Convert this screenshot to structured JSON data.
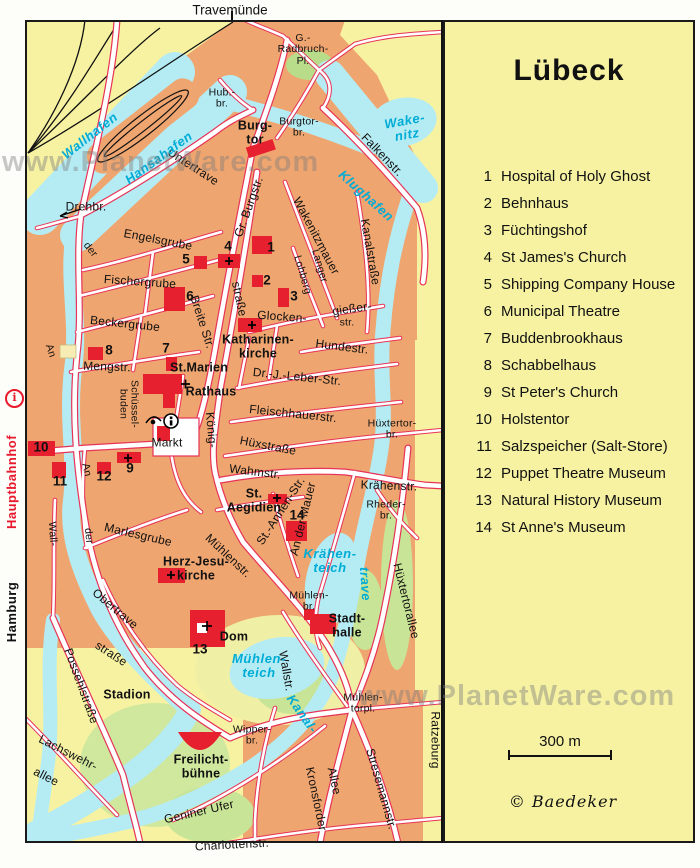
{
  "watermark": "www.PlanetWare.com",
  "top": {
    "destination": "Travemünde"
  },
  "side": {
    "city": "Hamburg",
    "station": "Hauptbahnhof",
    "info": "i"
  },
  "legend": {
    "title": "Lübeck",
    "scale": "300 m",
    "copyright": "© Baedeker",
    "items": [
      {
        "num": "1",
        "label": "Hospital of Holy Ghost"
      },
      {
        "num": "2",
        "label": "Behnhaus"
      },
      {
        "num": "3",
        "label": "Füchtingshof"
      },
      {
        "num": "4",
        "label": "St James's Church"
      },
      {
        "num": "5",
        "label": "Shipping Company House"
      },
      {
        "num": "6",
        "label": "Municipal Theatre"
      },
      {
        "num": "7",
        "label": "Buddenbrookhaus"
      },
      {
        "num": "8",
        "label": "Schabbelhaus"
      },
      {
        "num": "9",
        "label": "St Peter's Church"
      },
      {
        "num": "10",
        "label": "Holstentor"
      },
      {
        "num": "11",
        "label": "Salzspeicher (Salt-Store)"
      },
      {
        "num": "12",
        "label": "Puppet Theatre Museum"
      },
      {
        "num": "13",
        "label": "Natural History Museum"
      },
      {
        "num": "14",
        "label": "St Anne's Museum"
      }
    ]
  },
  "map": {
    "labels": [
      {
        "t": "Untertrave"
      },
      {
        "t": "der"
      },
      {
        "t": "An"
      },
      {
        "t": "Engelsgrube"
      },
      {
        "t": "Fischergrube"
      },
      {
        "t": "Beckergrube"
      },
      {
        "t": "Mengstr."
      },
      {
        "t": "Markt"
      },
      {
        "t": "Schüssel-\nbuden"
      },
      {
        "t": "Breite Str."
      },
      {
        "t": "straße"
      },
      {
        "t": "König-"
      },
      {
        "t": "Gr. Burgstr."
      },
      {
        "t": "Burgtor-\nbr."
      },
      {
        "t": "Hub.-\nbr."
      },
      {
        "t": "G.-\nRadbruch-\nPl."
      },
      {
        "t": "Falkenstr."
      },
      {
        "t": "Kanalstraße"
      },
      {
        "t": "Wakenitzmauer"
      },
      {
        "t": "Langer"
      },
      {
        "t": "Lohberg"
      },
      {
        "t": "Glocken-"
      },
      {
        "t": "gießer-"
      },
      {
        "t": "str."
      },
      {
        "t": "Hundestr."
      },
      {
        "t": "Dr.-J.-Leber-Str."
      },
      {
        "t": "Fleischhauerstr."
      },
      {
        "t": "Hüxtertor-\nbr."
      },
      {
        "t": "Hüxstraße"
      },
      {
        "t": "Wahmstr."
      },
      {
        "t": "Krähenstr."
      },
      {
        "t": "Rheder-\nbr."
      },
      {
        "t": "St.-Annen-Str."
      },
      {
        "t": "An der Mauer"
      },
      {
        "t": "Hüxtertorallee"
      },
      {
        "t": "Wallstr."
      },
      {
        "t": "Mühlenstr."
      },
      {
        "t": "Marlesgrube"
      },
      {
        "t": "Wall-"
      },
      {
        "t": "An"
      },
      {
        "t": "der"
      },
      {
        "t": "Obertrave"
      },
      {
        "t": "straße"
      },
      {
        "t": "Possehlstraße"
      },
      {
        "t": "Lachswehr-"
      },
      {
        "t": "allee"
      },
      {
        "t": "Geniner Ufer"
      },
      {
        "t": "Charlottenstr."
      },
      {
        "t": "Kronsforder"
      },
      {
        "t": "Allee"
      },
      {
        "t": "Stresemannstr."
      },
      {
        "t": "Mühlen-\ntorpl."
      },
      {
        "t": "Wipper-\nbr."
      },
      {
        "t": "Mühlen-\nbr."
      },
      {
        "t": "Ratzeburg"
      },
      {
        "t": "Drehbr."
      },
      {
        "t": "Burg-\ntor"
      },
      {
        "t": "St.Marien"
      },
      {
        "t": "Rathaus"
      },
      {
        "t": "Katharinen-\nkirche"
      },
      {
        "t": "St.\nAegidien"
      },
      {
        "t": "Herz-Jesu-\nkirche"
      },
      {
        "t": "Dom"
      },
      {
        "t": "Stadt-\nhalle"
      },
      {
        "t": "Freilicht-\nbühne"
      },
      {
        "t": "Stadion"
      },
      {
        "t": "Wallhafen"
      },
      {
        "t": "Hansahafen"
      },
      {
        "t": "Wake-\nnitz"
      },
      {
        "t": "Klughafen"
      },
      {
        "t": "Krähen-\nteich"
      },
      {
        "t": "Mühlen-\nteich"
      },
      {
        "t": "Kanal-"
      },
      {
        "t": "trave"
      },
      {
        "t": "1"
      },
      {
        "t": "2"
      },
      {
        "t": "3"
      },
      {
        "t": "4"
      },
      {
        "t": "5"
      },
      {
        "t": "6"
      },
      {
        "t": "7"
      },
      {
        "t": "8"
      },
      {
        "t": "9"
      },
      {
        "t": "10"
      },
      {
        "t": "11"
      },
      {
        "t": "12"
      },
      {
        "t": "13"
      },
      {
        "t": "14"
      }
    ]
  }
}
